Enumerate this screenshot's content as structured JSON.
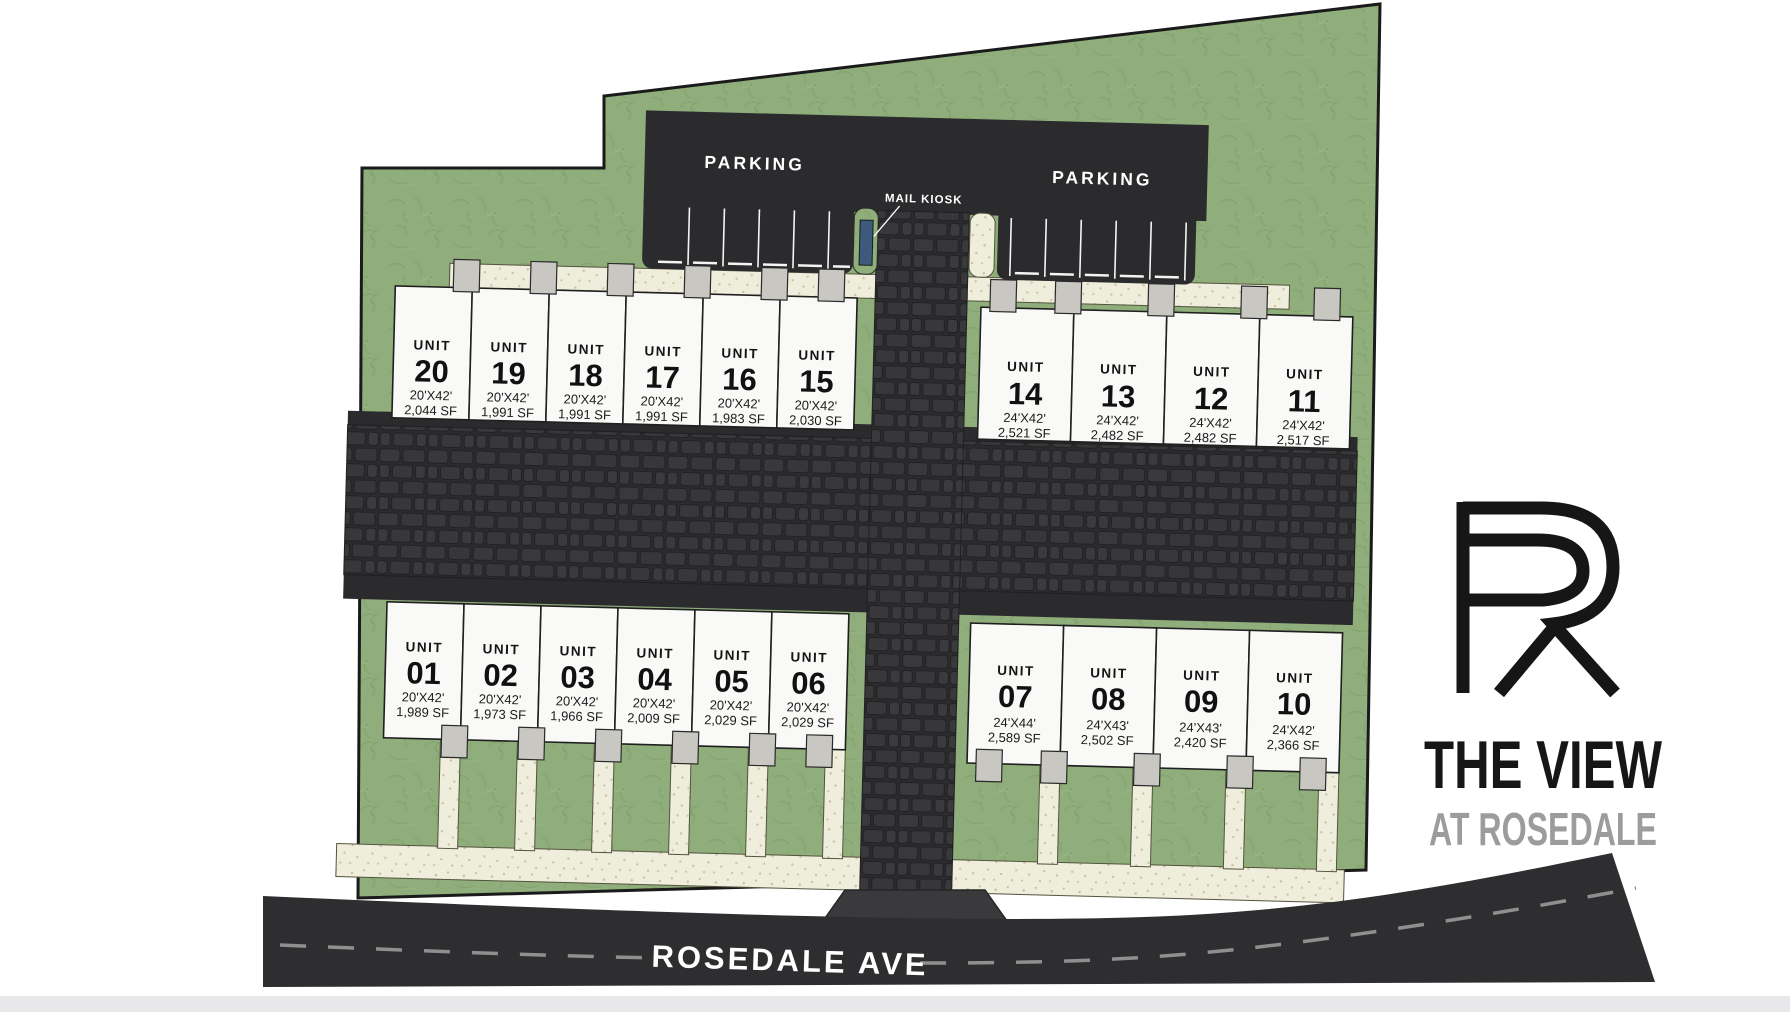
{
  "plan": {
    "unit_word": "UNIT",
    "parking": {
      "left_label": "PARKING",
      "right_label": "PARKING"
    },
    "mail_kiosk_label": "MAIL KIOSK",
    "street_name": "ROSEDALE AVE",
    "blocks": {
      "top_left": [
        {
          "number": "20",
          "dims": "20'X42'",
          "area": "2,044 SF"
        },
        {
          "number": "19",
          "dims": "20'X42'",
          "area": "1,991 SF"
        },
        {
          "number": "18",
          "dims": "20'X42'",
          "area": "1,991 SF"
        },
        {
          "number": "17",
          "dims": "20'X42'",
          "area": "1,991 SF"
        },
        {
          "number": "16",
          "dims": "20'X42'",
          "area": "1,983 SF"
        },
        {
          "number": "15",
          "dims": "20'X42'",
          "area": "2,030 SF"
        }
      ],
      "top_right": [
        {
          "number": "14",
          "dims": "24'X42'",
          "area": "2,521 SF"
        },
        {
          "number": "13",
          "dims": "24'X42'",
          "area": "2,482 SF"
        },
        {
          "number": "12",
          "dims": "24'X42'",
          "area": "2,482 SF"
        },
        {
          "number": "11",
          "dims": "24'X42'",
          "area": "2,517 SF"
        }
      ],
      "bottom_left": [
        {
          "number": "01",
          "dims": "20'X42'",
          "area": "1,989 SF"
        },
        {
          "number": "02",
          "dims": "20'X42'",
          "area": "1,973 SF"
        },
        {
          "number": "03",
          "dims": "20'X42'",
          "area": "1,966 SF"
        },
        {
          "number": "04",
          "dims": "20'X42'",
          "area": "2,009 SF"
        },
        {
          "number": "05",
          "dims": "20'X42'",
          "area": "2,029 SF"
        },
        {
          "number": "06",
          "dims": "20'X42'",
          "area": "2,029 SF"
        }
      ],
      "bottom_right": [
        {
          "number": "07",
          "dims": "24'X44'",
          "area": "2,589 SF"
        },
        {
          "number": "08",
          "dims": "24'X43'",
          "area": "2,502 SF"
        },
        {
          "number": "09",
          "dims": "24'X43'",
          "area": "2,420 SF"
        },
        {
          "number": "10",
          "dims": "24'X42'",
          "area": "2,366 SF"
        }
      ]
    },
    "logo": {
      "monogram": "R",
      "line1": "THE VIEW",
      "line2": "AT ROSEDALE"
    },
    "colors": {
      "site_green": "#8fae7b",
      "grass_stroke": "#7fa06a",
      "asphalt": "#2b2b2d",
      "street": "#2e2e30",
      "cobble_stone": "#39393b",
      "walkway_cream": "#efeddb",
      "unit_fill": "#f9f9f7",
      "porch_gray": "#c9c7c1",
      "kiosk_blue": "#3d5a7d",
      "logo_black": "#161616",
      "logo_gray": "#9c9c9c"
    }
  }
}
